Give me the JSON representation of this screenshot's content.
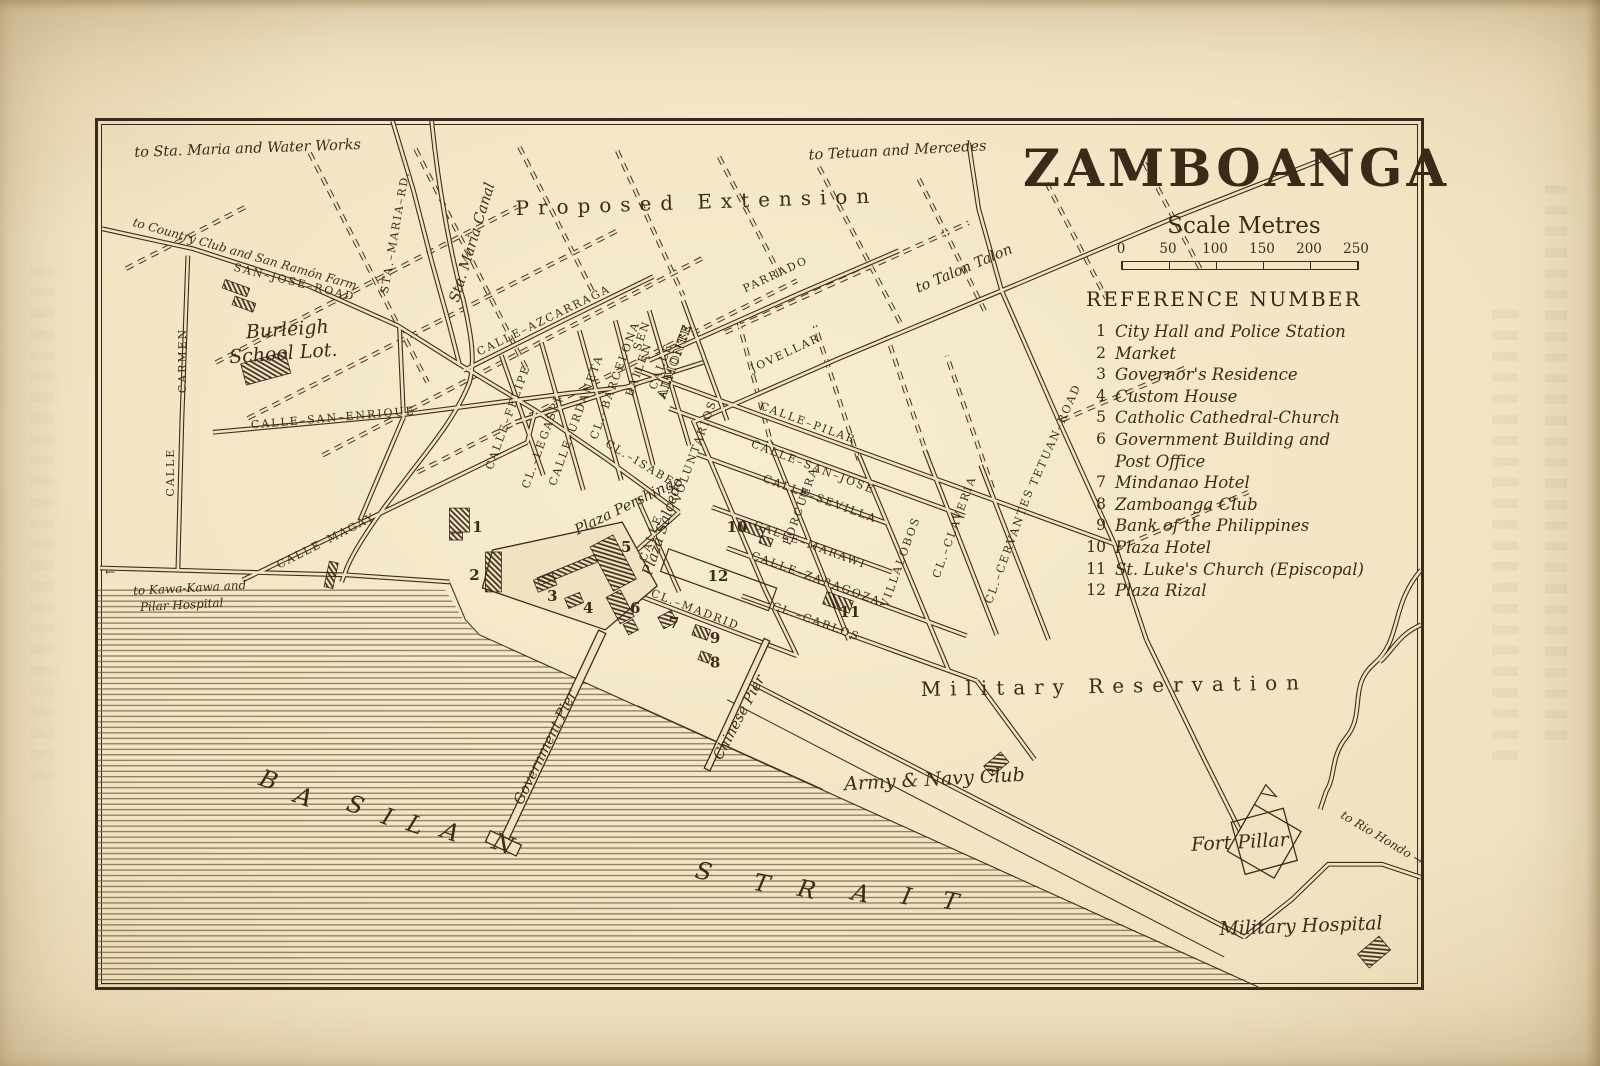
{
  "colors": {
    "paper": "#f1e3c2",
    "ink": "#3a2c19"
  },
  "title": "ZAMBOANGA",
  "scale": {
    "label": "Scale Metres",
    "ticks": [
      "0",
      "50",
      "100",
      "150",
      "200",
      "250"
    ]
  },
  "reference": {
    "heading": "REFERENCE NUMBER",
    "items": [
      {
        "n": "1",
        "name": "City Hall and Police Station"
      },
      {
        "n": "2",
        "name": "Market"
      },
      {
        "n": "3",
        "name": "Governor's Residence"
      },
      {
        "n": "4",
        "name": "Custom House"
      },
      {
        "n": "5",
        "name": "Catholic Cathedral-Church"
      },
      {
        "n": "6",
        "name": "Government Building and\nPost Office"
      },
      {
        "n": "7",
        "name": "Mindanao Hotel"
      },
      {
        "n": "8",
        "name": "Zamboanga Club"
      },
      {
        "n": "9",
        "name": "Bank of the Philippines"
      },
      {
        "n": "10",
        "name": "Plaza Hotel"
      },
      {
        "n": "11",
        "name": "St. Luke's Church (Episcopal)"
      },
      {
        "n": "12",
        "name": "Plaza Rizal"
      }
    ]
  },
  "map": {
    "labels": [
      {
        "t": "SAN–JOSE–ROAD",
        "x": 196,
        "y": 165,
        "r": 14,
        "c": "st"
      },
      {
        "t": "CALLE–AZCARRAGA",
        "x": 448,
        "y": 203,
        "r": -26,
        "c": "st"
      },
      {
        "t": "CALLE–SAN–ENRIQUE",
        "x": 236,
        "y": 301,
        "r": -5,
        "c": "st"
      },
      {
        "t": "CALLE–MAGAY",
        "x": 230,
        "y": 424,
        "r": -27,
        "c": "st"
      },
      {
        "t": "CALLE",
        "x": 76,
        "y": 352,
        "r": -90,
        "c": "st"
      },
      {
        "t": "CARMEN",
        "x": 88,
        "y": 240,
        "r": -90,
        "c": "st"
      },
      {
        "t": "STA.–MARIA–RD.",
        "x": 301,
        "y": 112,
        "r": -80,
        "c": "st"
      },
      {
        "t": "PARRADO",
        "x": 680,
        "y": 157,
        "r": -25,
        "c": "st"
      },
      {
        "t": "JOVELLAR",
        "x": 690,
        "y": 236,
        "r": -25,
        "c": "st"
      },
      {
        "t": "CALLE–PILAR",
        "x": 710,
        "y": 306,
        "r": 20,
        "c": "st"
      },
      {
        "t": "CALLE–SAN–JOSE",
        "x": 715,
        "y": 350,
        "r": 21,
        "c": "st"
      },
      {
        "t": "CALLE–SEVILLA",
        "x": 722,
        "y": 382,
        "r": 20,
        "c": "st"
      },
      {
        "t": "CALLE–MARAWI",
        "x": 712,
        "y": 428,
        "r": 20,
        "c": "st"
      },
      {
        "t": "CALLE–ZARAGOZA",
        "x": 718,
        "y": 462,
        "r": 20,
        "c": "st"
      },
      {
        "t": "CL.–CARLOS",
        "x": 718,
        "y": 505,
        "r": 20,
        "c": "st"
      },
      {
        "t": "CL.–MADRID",
        "x": 597,
        "y": 493,
        "r": 21,
        "c": "st"
      },
      {
        "t": "CL.–ISABEL",
        "x": 545,
        "y": 348,
        "r": 31,
        "c": "st"
      },
      {
        "t": "VOLUNTARIOS",
        "x": 601,
        "y": 332,
        "r": -70,
        "c": "st"
      },
      {
        "t": "PORCUERA",
        "x": 707,
        "y": 387,
        "r": -70,
        "c": "st"
      },
      {
        "t": "VILLALOBOS",
        "x": 807,
        "y": 443,
        "r": -70,
        "c": "st"
      },
      {
        "t": "CL.–CLAVERIA",
        "x": 861,
        "y": 408,
        "r": -70,
        "c": "st"
      },
      {
        "t": "CL.–CERVANTES",
        "x": 916,
        "y": 427,
        "r": -70,
        "c": "st"
      },
      {
        "t": "TETUAN–ROAD",
        "x": 962,
        "y": 316,
        "r": -66,
        "c": "st"
      },
      {
        "t": "CALLE–FELIPE",
        "x": 414,
        "y": 298,
        "r": -70,
        "c": "st"
      },
      {
        "t": "CL.–LEGASPI",
        "x": 448,
        "y": 323,
        "r": -70,
        "c": "st"
      },
      {
        "t": "CALLE–URDANETA",
        "x": 482,
        "y": 301,
        "r": -70,
        "c": "st"
      },
      {
        "t": "CL.–BARCELONA",
        "x": 521,
        "y": 261,
        "r": -70,
        "c": "st"
      },
      {
        "t": "BAILEN",
        "x": 545,
        "y": 250,
        "r": -70,
        "c": "st"
      },
      {
        "t": "SEN",
        "x": 548,
        "y": 216,
        "r": -70,
        "c": "st"
      },
      {
        "t": "CALLE",
        "x": 567,
        "y": 247,
        "r": -70,
        "c": "st"
      },
      {
        "t": "ALMONTE",
        "x": 581,
        "y": 242,
        "r": -70,
        "c": "sto"
      },
      {
        "t": "CALLE",
        "x": 557,
        "y": 419,
        "r": -70,
        "c": "st"
      },
      {
        "t": "to Sta. Maria and Water Works",
        "x": 150,
        "y": 32,
        "r": -2,
        "c": "it"
      },
      {
        "t": "to Tetuan and Mercedes",
        "x": 801,
        "y": 34,
        "r": -3,
        "c": "it"
      },
      {
        "t": "to Country Club and San Ramón Farm",
        "x": 146,
        "y": 137,
        "r": 16,
        "c": "its"
      },
      {
        "t": "to Talon Talon",
        "x": 869,
        "y": 152,
        "r": -23,
        "c": "it"
      },
      {
        "t": "Sta. Maria Canal",
        "x": 379,
        "y": 123,
        "r": -73,
        "c": "it"
      },
      {
        "t": "to Kawa-Kawa and",
        "x": 92,
        "y": 472,
        "r": -3,
        "c": "its"
      },
      {
        "t": "Pilar Hospital",
        "x": 84,
        "y": 489,
        "r": -3,
        "c": "its"
      },
      {
        "t": "←",
        "x": 12,
        "y": 456,
        "r": 0,
        "c": "its"
      },
      {
        "t": "Plaza Pershing",
        "x": 529,
        "y": 391,
        "r": -26,
        "c": "it"
      },
      {
        "t": "Plaza Salcedo",
        "x": 570,
        "y": 408,
        "r": -72,
        "c": "it"
      },
      {
        "t": "Government Pier",
        "x": 452,
        "y": 630,
        "r": -64,
        "c": "it"
      },
      {
        "t": "Chinese Pier",
        "x": 646,
        "y": 600,
        "r": -62,
        "c": "it"
      },
      {
        "t": "Army & Navy Club",
        "x": 838,
        "y": 666,
        "r": -3,
        "c": "itb"
      },
      {
        "t": "Fort Pillar",
        "x": 1144,
        "y": 729,
        "r": -3,
        "c": "itb"
      },
      {
        "t": "Military Hospital",
        "x": 1205,
        "y": 813,
        "r": -2,
        "c": "itb"
      },
      {
        "t": "to Rio Hondo →",
        "x": 1284,
        "y": 722,
        "r": 31,
        "c": "its"
      },
      {
        "t": "Burleigh",
        "x": 190,
        "y": 215,
        "r": -4,
        "c": "itb"
      },
      {
        "t": "School Lot.",
        "x": 186,
        "y": 239,
        "r": -4,
        "c": "itb"
      },
      {
        "t": "Proposed  Extension",
        "x": 600,
        "y": 88,
        "r": -2,
        "c": "big"
      },
      {
        "t": "Military  Reservation",
        "x": 1018,
        "y": 573,
        "r": -1,
        "c": "big"
      }
    ],
    "sea_words": [
      {
        "word": "BASILAN",
        "rot": 20,
        "pts": [
          [
            168,
            668
          ],
          [
            203,
            685
          ],
          [
            255,
            693
          ],
          [
            287,
            705
          ],
          [
            315,
            713
          ],
          [
            350,
            720
          ],
          [
            403,
            732
          ]
        ]
      },
      {
        "word": "STRAIT",
        "rot": 12,
        "pts": [
          [
            605,
            760
          ],
          [
            663,
            772
          ],
          [
            708,
            778
          ],
          [
            762,
            782
          ],
          [
            808,
            785
          ],
          [
            852,
            790
          ]
        ]
      }
    ],
    "markers": [
      {
        "n": "1",
        "x": 380,
        "y": 412
      },
      {
        "n": "2",
        "x": 377,
        "y": 460
      },
      {
        "n": "3",
        "x": 455,
        "y": 481
      },
      {
        "n": "4",
        "x": 491,
        "y": 493
      },
      {
        "n": "5",
        "x": 529,
        "y": 432
      },
      {
        "n": "6",
        "x": 538,
        "y": 493
      },
      {
        "n": "7",
        "x": 577,
        "y": 508
      },
      {
        "n": "8",
        "x": 618,
        "y": 548
      },
      {
        "n": "9",
        "x": 618,
        "y": 523
      },
      {
        "n": "10",
        "x": 640,
        "y": 412
      },
      {
        "n": "11",
        "x": 753,
        "y": 497
      },
      {
        "n": "12",
        "x": 621,
        "y": 461
      }
    ]
  }
}
